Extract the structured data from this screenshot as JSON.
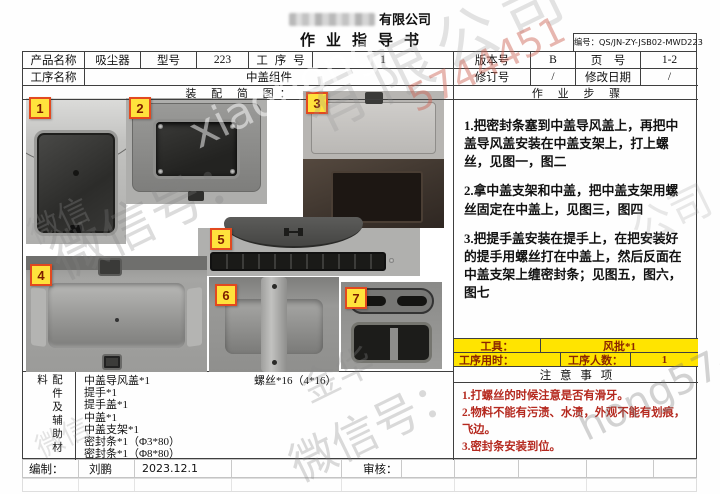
{
  "page": {
    "company_suffix": "有限公司",
    "title": "作业指导书",
    "doc_no_label": "编号：",
    "doc_no": "QS/JN-ZY-JSB02-MWD223"
  },
  "info": {
    "product_label": "产品名称",
    "product": "吸尘器",
    "model_label": "型号",
    "model": "223",
    "process_no_label": "工 序 号",
    "process_no": "1",
    "version_label": "版本号",
    "version": "B",
    "page_label": "页　号",
    "page_no": "1-2",
    "process_name_label": "工序名称",
    "process_name": "中盖组件",
    "revision_label": "修订号",
    "revision": "/",
    "rev_date_label": "修改日期",
    "rev_date": "/"
  },
  "diagram": {
    "header": "装 配 简 图：",
    "tags": [
      "1",
      "2",
      "3",
      "4",
      "5",
      "6",
      "7"
    ]
  },
  "steps": {
    "header": "作 业 步 骤",
    "items": [
      "1.把密封条塞到中盖导风盖上，再把中盖导风盖安装在中盖支架上，打上螺丝，见图一，图二",
      "2.拿中盖支架和中盖，把中盖支架用螺丝固定在中盖上，见图三，图四",
      "3.把提手盖安装在提手上，在把安装好的提手用螺丝打在中盖上，然后反面在中盖支架上缠密封条；见图五，图六，图七"
    ]
  },
  "tools": {
    "tool_label": "工具：",
    "tool_value": "风批*1",
    "time_label": "工序用时：",
    "time_value": "",
    "people_label": "工序人数：",
    "people_value": "1"
  },
  "notes": {
    "header": "注 意 事 项",
    "items": [
      "1.打螺丝的时候注意是否有滑牙。",
      "2.物料不能有污渍、水渍，外观不能有划痕，飞边。",
      "3.密封条安装到位。"
    ]
  },
  "materials": {
    "label": "配件及辅助材料",
    "items": [
      "中盖导风盖*1",
      "提手*1",
      "提手盖*1",
      "中盖*1",
      "中盖支架*1",
      "密封条*1（Φ3*80）",
      "密封条*1（Φ8*80）"
    ],
    "screws": "螺丝*16（4*16）"
  },
  "footer": {
    "prepared_label": "编制：",
    "prepared_name": "刘鹏",
    "prepared_date": "2023.12.1",
    "review_label": "审核：",
    "review_value": ""
  },
  "watermarks": {
    "company": "有限公司",
    "number_red": "5744451",
    "wechat_big": "微信号：",
    "latin_photos": "xiaohong",
    "latin_right": "hong574",
    "jinhua": "金华",
    "wechat_bottom": "微信号：",
    "wechat_left": "微信",
    "wechat_left2": "微信",
    "gongsi": "公司"
  },
  "colors": {
    "highlight_yellow": "#ffe400",
    "note_red": "#b5291f",
    "tag_bg": "#ffe23c",
    "tag_border": "#e2491f",
    "tag_text": "#7c1d00"
  }
}
